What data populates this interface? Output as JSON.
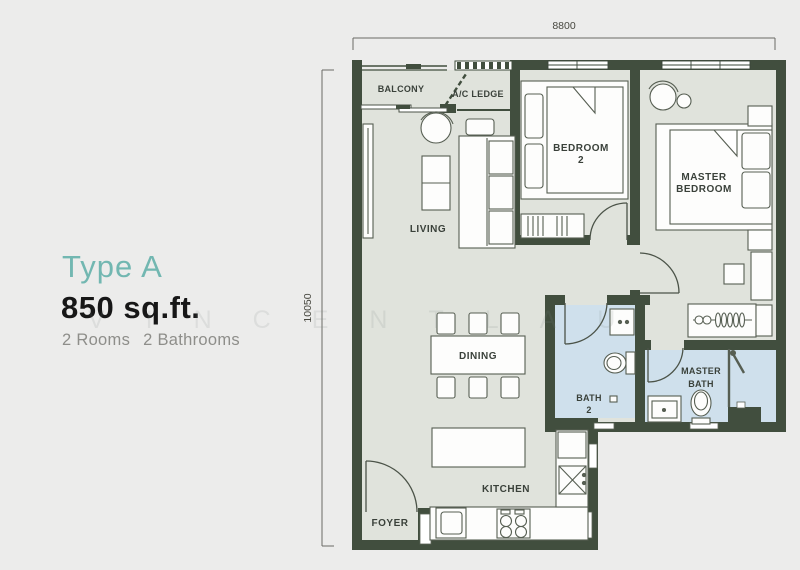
{
  "panel": {
    "type": "Type A",
    "area": "850 sq.ft.",
    "rooms_label": "2 Rooms",
    "baths_label": "2 Bathrooms"
  },
  "dimensions": {
    "top": "8800",
    "left": "10050"
  },
  "rooms": {
    "balcony": "BALCONY",
    "ac_ledge": "A/C LEDGE",
    "living": "LIVING",
    "bedroom2": {
      "line1": "BEDROOM",
      "line2": "2"
    },
    "master_bedroom": {
      "line1": "MASTER",
      "line2": "BEDROOM"
    },
    "dining": "DINING",
    "bath2": {
      "line1": "BATH",
      "line2": "2"
    },
    "master_bath": {
      "line1": "MASTER",
      "line2": "BATH"
    },
    "kitchen": "KITCHEN",
    "foyer": "FOYER"
  },
  "watermark": "VINCENTLAU",
  "colors": {
    "background": "#ececeb",
    "wall": "#414e3e",
    "floor": "#e0e3dc",
    "bath_floor": "#cfe0ec",
    "accent_teal": "#72b7b1",
    "furniture_stroke": "#565e52"
  }
}
